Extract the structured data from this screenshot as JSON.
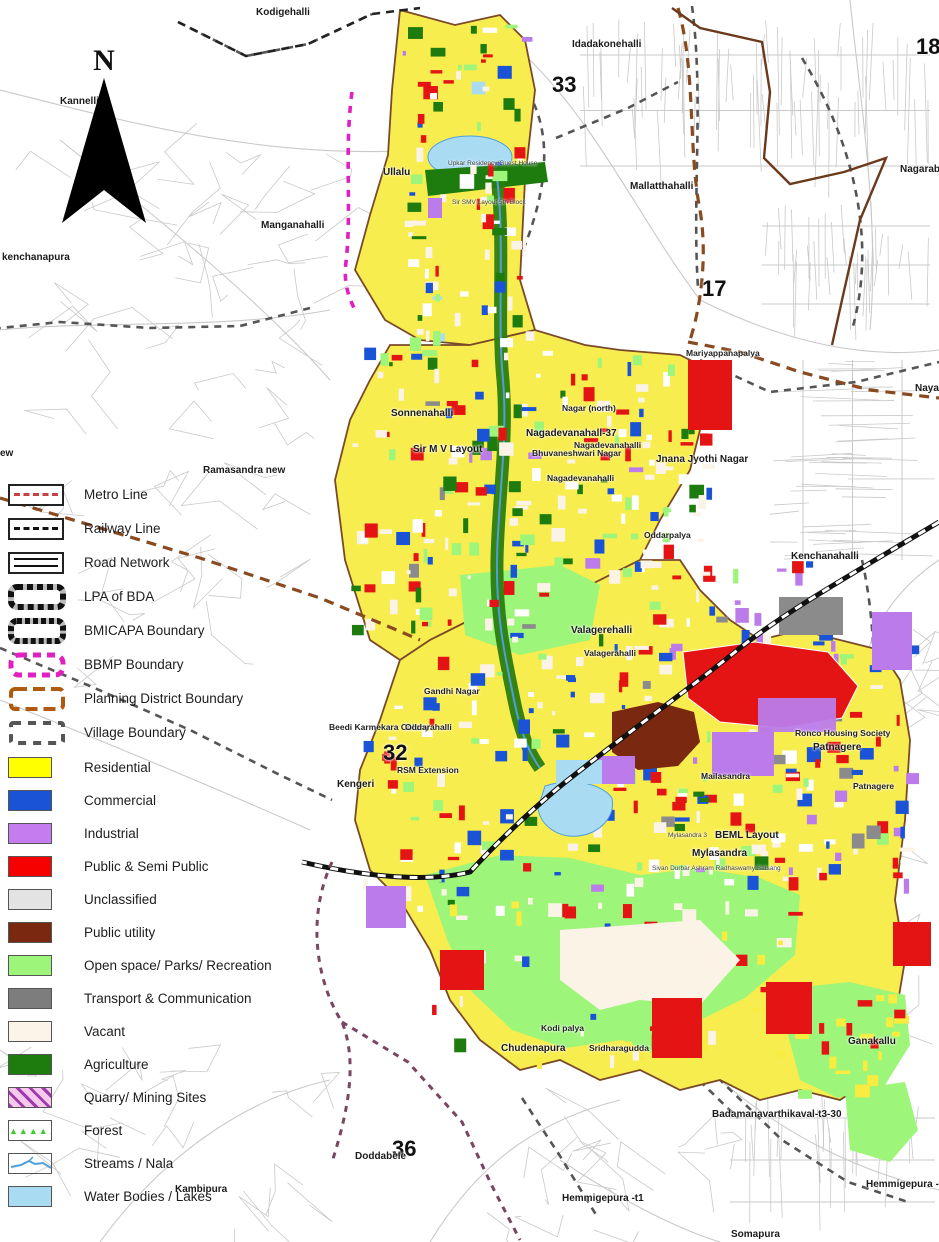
{
  "compass": {
    "label": "N"
  },
  "legend": {
    "line_items": [
      {
        "label": "Metro Line",
        "type": "metro"
      },
      {
        "label": "Railway Line",
        "type": "railway"
      },
      {
        "label": "Road Network",
        "type": "road"
      },
      {
        "label": "LPA of BDA",
        "type": "lpa"
      },
      {
        "label": "BMICAPA Boundary",
        "type": "bmicapa"
      },
      {
        "label": "BBMP Boundary",
        "type": "bbmp"
      },
      {
        "label": "Planning District Boundary",
        "type": "district"
      },
      {
        "label": "Village Boundary",
        "type": "village"
      }
    ],
    "area_items": [
      {
        "label": "Residential",
        "type": "fill",
        "color": "#FFFF00"
      },
      {
        "label": "Commercial",
        "type": "fill",
        "color": "#1A53D6"
      },
      {
        "label": "Industrial",
        "type": "fill",
        "color": "#C57CEF"
      },
      {
        "label": "Public & Semi Public",
        "type": "fill",
        "color": "#F60000"
      },
      {
        "label": "Unclassified",
        "type": "fill",
        "color": "#E3E3E3"
      },
      {
        "label": "Public utility",
        "type": "fill",
        "color": "#7A2810"
      },
      {
        "label": "Open space/ Parks/ Recreation",
        "type": "fill",
        "color": "#9DF579"
      },
      {
        "label": "Transport & Communication",
        "type": "fill",
        "color": "#7D7D7D"
      },
      {
        "label": "Vacant",
        "type": "fill",
        "color": "#FBF4E9"
      },
      {
        "label": "Agriculture",
        "type": "fill",
        "color": "#1E7B0E"
      },
      {
        "label": "Quarry/ Mining Sites",
        "type": "quarry"
      },
      {
        "label": "Forest",
        "type": "forest"
      },
      {
        "label": "Streams / Nala",
        "type": "stream"
      },
      {
        "label": "Water Bodies / Lakes",
        "type": "fill",
        "color": "#A9DCF3"
      }
    ]
  },
  "map_labels": [
    {
      "text": "Kodigehalli",
      "x": 256,
      "y": 8,
      "cls": "town"
    },
    {
      "text": "Idadakonehalli",
      "x": 572,
      "y": 40,
      "cls": "town"
    },
    {
      "text": "33",
      "x": 552,
      "y": 74,
      "cls": "num"
    },
    {
      "text": "18",
      "x": 916,
      "y": 36,
      "cls": "num"
    },
    {
      "text": "Kannelli",
      "x": 60,
      "y": 97,
      "cls": "town"
    },
    {
      "text": "Nagarab",
      "x": 900,
      "y": 165,
      "cls": "town"
    },
    {
      "text": "Ullalu",
      "x": 383,
      "y": 168,
      "cls": "town"
    },
    {
      "text": "Upkar Residency/Guest House",
      "x": 448,
      "y": 161,
      "cls": "small"
    },
    {
      "text": "Sir SMV Layout 5th Block",
      "x": 452,
      "y": 200,
      "cls": "small"
    },
    {
      "text": "Manganahalli",
      "x": 261,
      "y": 221,
      "cls": "town"
    },
    {
      "text": "kenchanapura",
      "x": 2,
      "y": 253,
      "cls": "town"
    },
    {
      "text": "Mallatthahalli",
      "x": 630,
      "y": 182,
      "cls": "town"
    },
    {
      "text": "17",
      "x": 702,
      "y": 278,
      "cls": "num"
    },
    {
      "text": "Mariyappanapalya",
      "x": 686,
      "y": 349,
      "cls": "place"
    },
    {
      "text": "Nayan",
      "x": 915,
      "y": 384,
      "cls": "town"
    },
    {
      "text": "Sonnenahalli",
      "x": 391,
      "y": 409,
      "cls": "town"
    },
    {
      "text": "Nagar (north)",
      "x": 562,
      "y": 404,
      "cls": "place"
    },
    {
      "text": "Nagadevanahall-37",
      "x": 526,
      "y": 429,
      "cls": "town"
    },
    {
      "text": "Nagadevanahalli",
      "x": 574,
      "y": 441,
      "cls": "place"
    },
    {
      "text": "Bhuvaneshwari Nagar",
      "x": 532,
      "y": 449,
      "cls": "place"
    },
    {
      "text": "Sir M V Layout",
      "x": 413,
      "y": 445,
      "cls": "town"
    },
    {
      "text": "Ramasandra new",
      "x": 203,
      "y": 466,
      "cls": "town"
    },
    {
      "text": "Nagadevanahalli",
      "x": 547,
      "y": 474,
      "cls": "place"
    },
    {
      "text": "Jnana Jyothi Nagar",
      "x": 656,
      "y": 455,
      "cls": "town"
    },
    {
      "text": "Oddarpalya",
      "x": 644,
      "y": 531,
      "cls": "place"
    },
    {
      "text": "Kenchanahalli",
      "x": 791,
      "y": 552,
      "cls": "town"
    },
    {
      "text": "ew",
      "x": 0,
      "y": 449,
      "cls": "town"
    },
    {
      "text": "Valagerehalli",
      "x": 571,
      "y": 626,
      "cls": "town"
    },
    {
      "text": "Valagerahalli",
      "x": 584,
      "y": 649,
      "cls": "place"
    },
    {
      "text": "Gandhi Nagar",
      "x": 424,
      "y": 687,
      "cls": "place"
    },
    {
      "text": "Beedi Karmekara Colony",
      "x": 329,
      "y": 723,
      "cls": "place"
    },
    {
      "text": "Oddarahalli",
      "x": 405,
      "y": 723,
      "cls": "place"
    },
    {
      "text": "32",
      "x": 383,
      "y": 742,
      "cls": "num"
    },
    {
      "text": "RSM Extension",
      "x": 397,
      "y": 766,
      "cls": "place"
    },
    {
      "text": "Kengeri",
      "x": 337,
      "y": 780,
      "cls": "town"
    },
    {
      "text": "Ronco Housing Society",
      "x": 795,
      "y": 729,
      "cls": "place"
    },
    {
      "text": "Patnagere",
      "x": 813,
      "y": 743,
      "cls": "town"
    },
    {
      "text": "Patnagere",
      "x": 853,
      "y": 782,
      "cls": "place"
    },
    {
      "text": "Mailasandra",
      "x": 701,
      "y": 772,
      "cls": "place"
    },
    {
      "text": "BEML Layout",
      "x": 715,
      "y": 831,
      "cls": "town"
    },
    {
      "text": "Mylasandra 3",
      "x": 668,
      "y": 833,
      "cls": "small"
    },
    {
      "text": "Mylasandra",
      "x": 692,
      "y": 849,
      "cls": "town"
    },
    {
      "text": "Sivan Durbar Ashram Radhaswamy Satsang",
      "x": 652,
      "y": 866,
      "cls": "small"
    },
    {
      "text": "Kodi palya",
      "x": 541,
      "y": 1024,
      "cls": "place"
    },
    {
      "text": "Chudenapura",
      "x": 501,
      "y": 1044,
      "cls": "town"
    },
    {
      "text": "Sridharagudda",
      "x": 589,
      "y": 1044,
      "cls": "place"
    },
    {
      "text": "Ganakallu",
      "x": 848,
      "y": 1037,
      "cls": "town"
    },
    {
      "text": "36",
      "x": 392,
      "y": 1138,
      "cls": "num"
    },
    {
      "text": "Doddabele",
      "x": 355,
      "y": 1152,
      "cls": "town"
    },
    {
      "text": "Kambipura",
      "x": 175,
      "y": 1185,
      "cls": "town"
    },
    {
      "text": "Badamanavarthikaval-t3-30",
      "x": 712,
      "y": 1110,
      "cls": "town"
    },
    {
      "text": "Hemmigepura -t1",
      "x": 562,
      "y": 1194,
      "cls": "town"
    },
    {
      "text": "Hemmigepura -t",
      "x": 866,
      "y": 1180,
      "cls": "town"
    },
    {
      "text": "Somapura",
      "x": 731,
      "y": 1230,
      "cls": "town"
    }
  ],
  "colors": {
    "residential": "#F8ED4E",
    "commercial": "#1A53D6",
    "industrial": "#BC7BEA",
    "public_semi_public": "#E51414",
    "unclassified": "#E3E3E3",
    "public_utility": "#7A2810",
    "open_space": "#9DF579",
    "transport": "#8B8B8B",
    "vacant": "#FAF3E6",
    "agriculture": "#1E7B0E",
    "water": "#A9DCF3",
    "stream": "#4E9FDE",
    "road": "#C9C9C9",
    "boundary_district": "#8A4A1F",
    "boundary_bbmp": "#E020C0",
    "boundary_village": "#555555",
    "railway": "#111111"
  }
}
